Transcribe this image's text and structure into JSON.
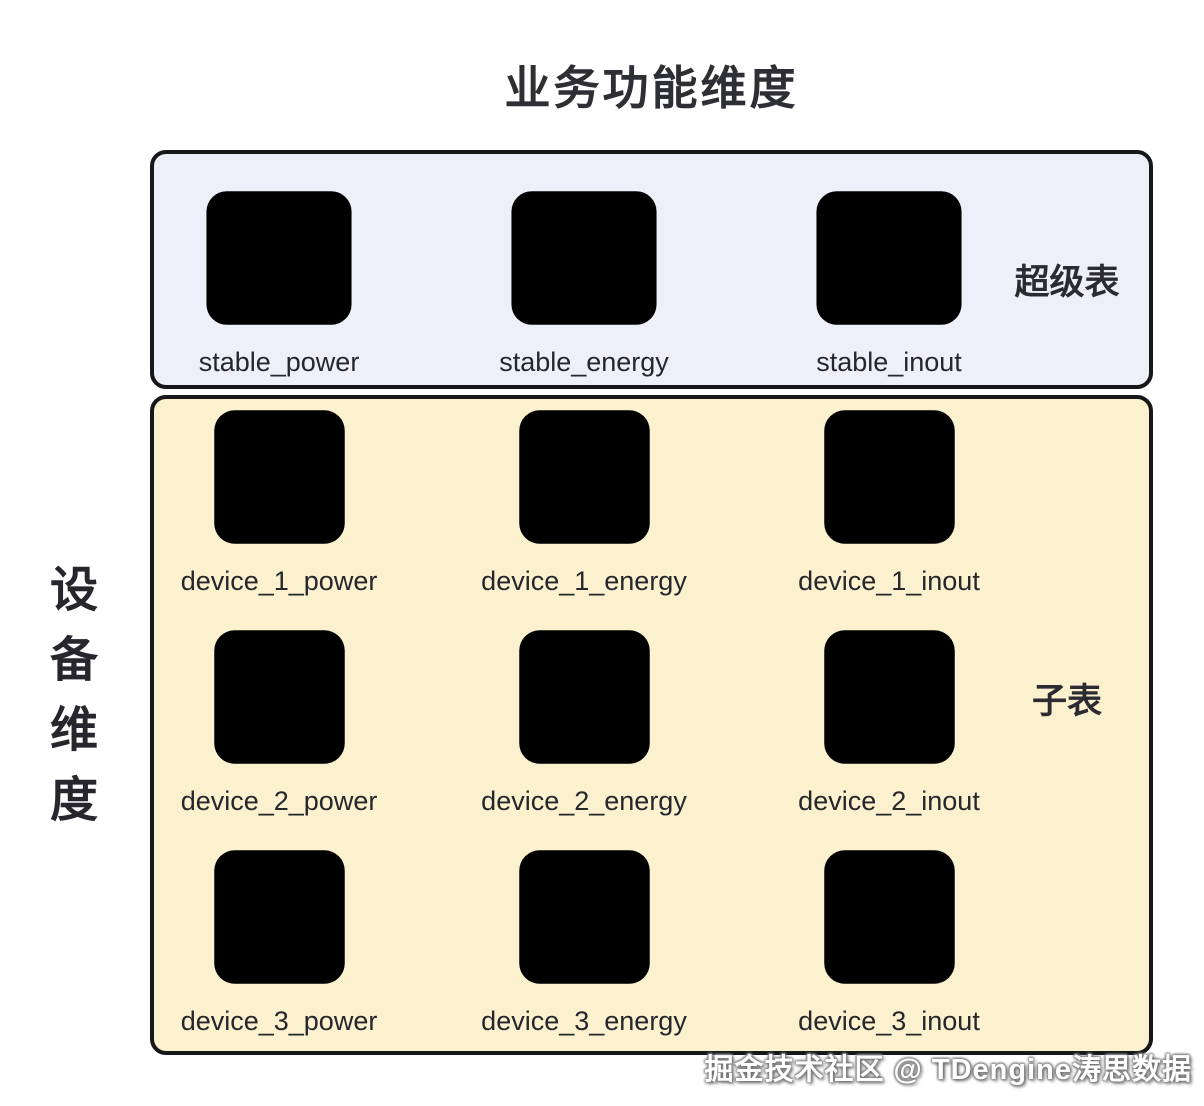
{
  "page": {
    "title": "业务功能维度",
    "left_axis_label": "设备维度",
    "left_axis_chars": [
      "设",
      "备",
      "维",
      "度"
    ],
    "watermark": "掘金技术社区 @ TDengine涛思数据"
  },
  "super_section": {
    "side_label": "超级表",
    "icon": "super-table-icon",
    "tables": [
      {
        "label": "stable_power"
      },
      {
        "label": "stable_energy"
      },
      {
        "label": "stable_inout"
      }
    ]
  },
  "sub_section": {
    "side_label": "子表",
    "icon": "sub-table-icon",
    "rows": [
      [
        {
          "label": "device_1_power"
        },
        {
          "label": "device_1_energy"
        },
        {
          "label": "device_1_inout"
        }
      ],
      [
        {
          "label": "device_2_power"
        },
        {
          "label": "device_2_energy"
        },
        {
          "label": "device_2_inout"
        }
      ],
      [
        {
          "label": "device_3_power"
        },
        {
          "label": "device_3_energy"
        },
        {
          "label": "device_3_inout"
        }
      ]
    ]
  },
  "colors": {
    "super_panel_bg": "#EDF0F8",
    "sub_panel_bg": "#FBF1CE",
    "panel_border": "#17171A",
    "icon_stroke": "#141417",
    "text": "#26262C",
    "page_bg": "#FFFFFF",
    "watermark_text": "#FFFFFF"
  }
}
